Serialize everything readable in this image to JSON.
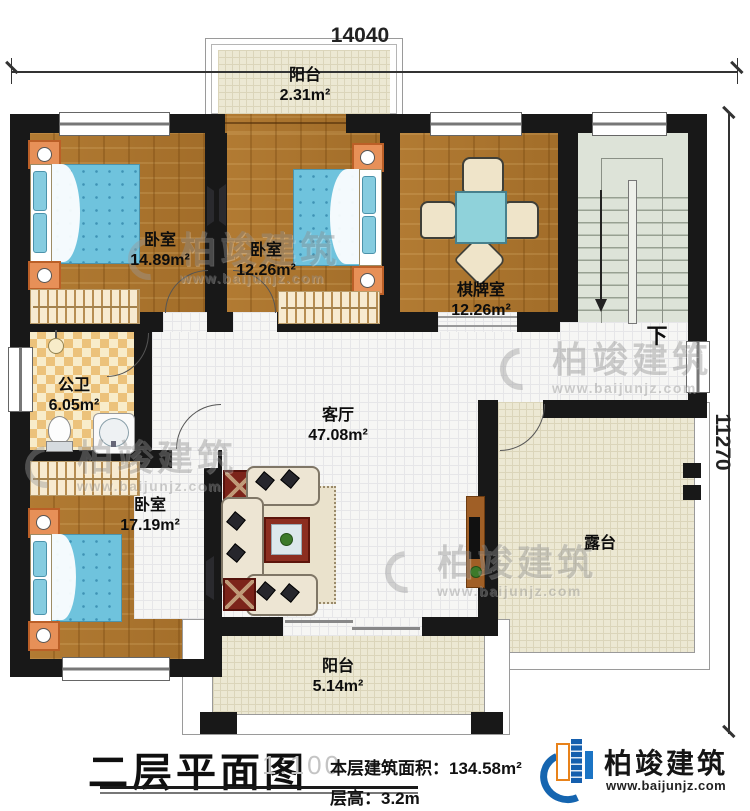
{
  "dimensions": {
    "width_label": "14040",
    "height_label": "11270"
  },
  "rooms": {
    "balcony_top": {
      "name": "阳台",
      "area": "2.31m²"
    },
    "bedroom_left": {
      "name": "卧室",
      "area": "14.89m²"
    },
    "bedroom_mid": {
      "name": "卧室",
      "area": "12.26m²"
    },
    "chess_room": {
      "name": "棋牌室",
      "area": "12.26m²"
    },
    "bathroom": {
      "name": "公卫",
      "area": "6.05m²"
    },
    "living_room": {
      "name": "客厅",
      "area": "47.08m²"
    },
    "bedroom_big": {
      "name": "卧室",
      "area": "17.19m²"
    },
    "terrace": {
      "name": "露台"
    },
    "balcony_bottom": {
      "name": "阳台",
      "area": "5.14m²"
    }
  },
  "stairs": {
    "down_label": "下"
  },
  "watermark": {
    "name": "柏竣建筑",
    "url": "www.baijunjz.com"
  },
  "footer": {
    "plan_title": "二层平面图",
    "scale": "1:100",
    "area_text": "本层建筑面积：134.58m²",
    "floor_height_text": "层高：3.2m"
  },
  "brand": {
    "name": "柏竣建筑",
    "url": "www.baijunjz.com"
  },
  "palette": {
    "wall": "#181818",
    "wood_floor": "#ac762f",
    "tile_floor": "#f6f6f4",
    "terrace_floor": "#ece8d3",
    "stairs_floor": "#dde3d8",
    "bath_tile": "#ecc27b",
    "bed_blue": "#6fc3dd",
    "table_cyan": "#8fd2da",
    "brand_blue": "#1565b0",
    "brand_orange": "#e8821a"
  }
}
